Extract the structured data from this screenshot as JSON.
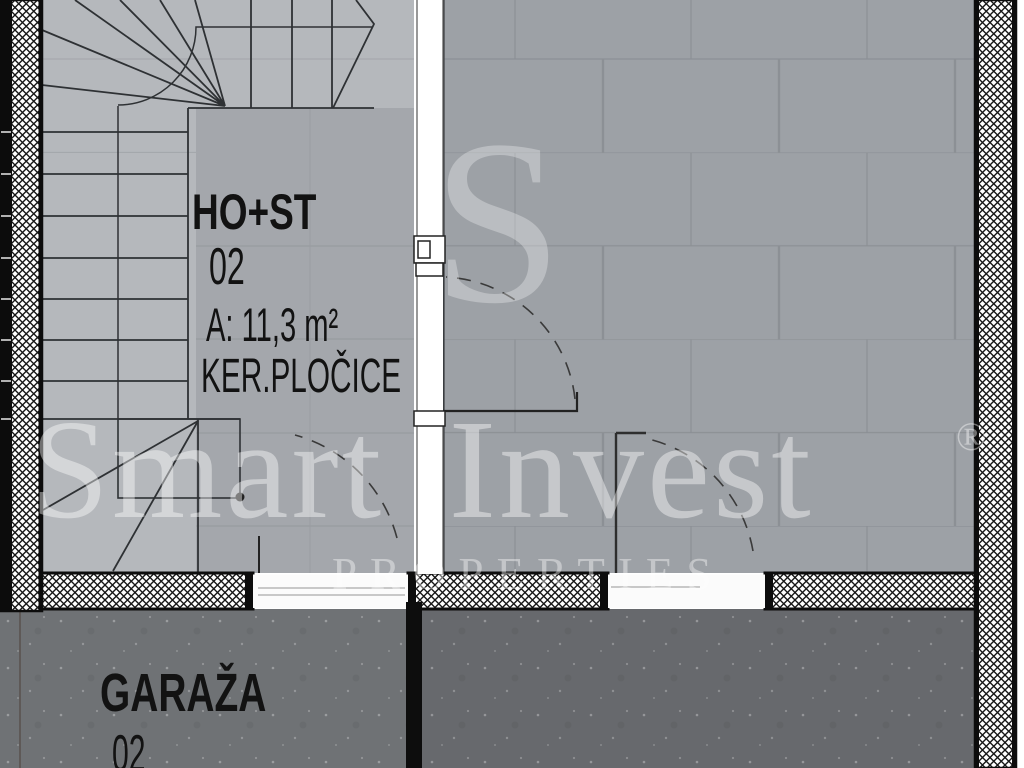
{
  "rooms": {
    "hallway": {
      "name": "HO+ST",
      "number": "02",
      "area": "A: 11,3 m²",
      "flooring": "KER.PLOČICE"
    },
    "garage": {
      "name": "GARAŽA",
      "number": "02"
    }
  },
  "watermark": {
    "monogram": "S",
    "brand": "Smart Invest",
    "registered": "®",
    "tagline": "PROPERTIES"
  },
  "colors": {
    "wall_line": "#0c0c0c",
    "stair_floor": "#b5b8bc",
    "hallway_floor": "#a4a7ac",
    "tiled_floor": "#9da1a6",
    "tile_grout": "#8c9095",
    "garage_floor_left": "#6f7275",
    "garage_floor_right": "#67696d",
    "label_text": "#121212",
    "watermark_text": "rgba(255,255,255,0.42)"
  }
}
